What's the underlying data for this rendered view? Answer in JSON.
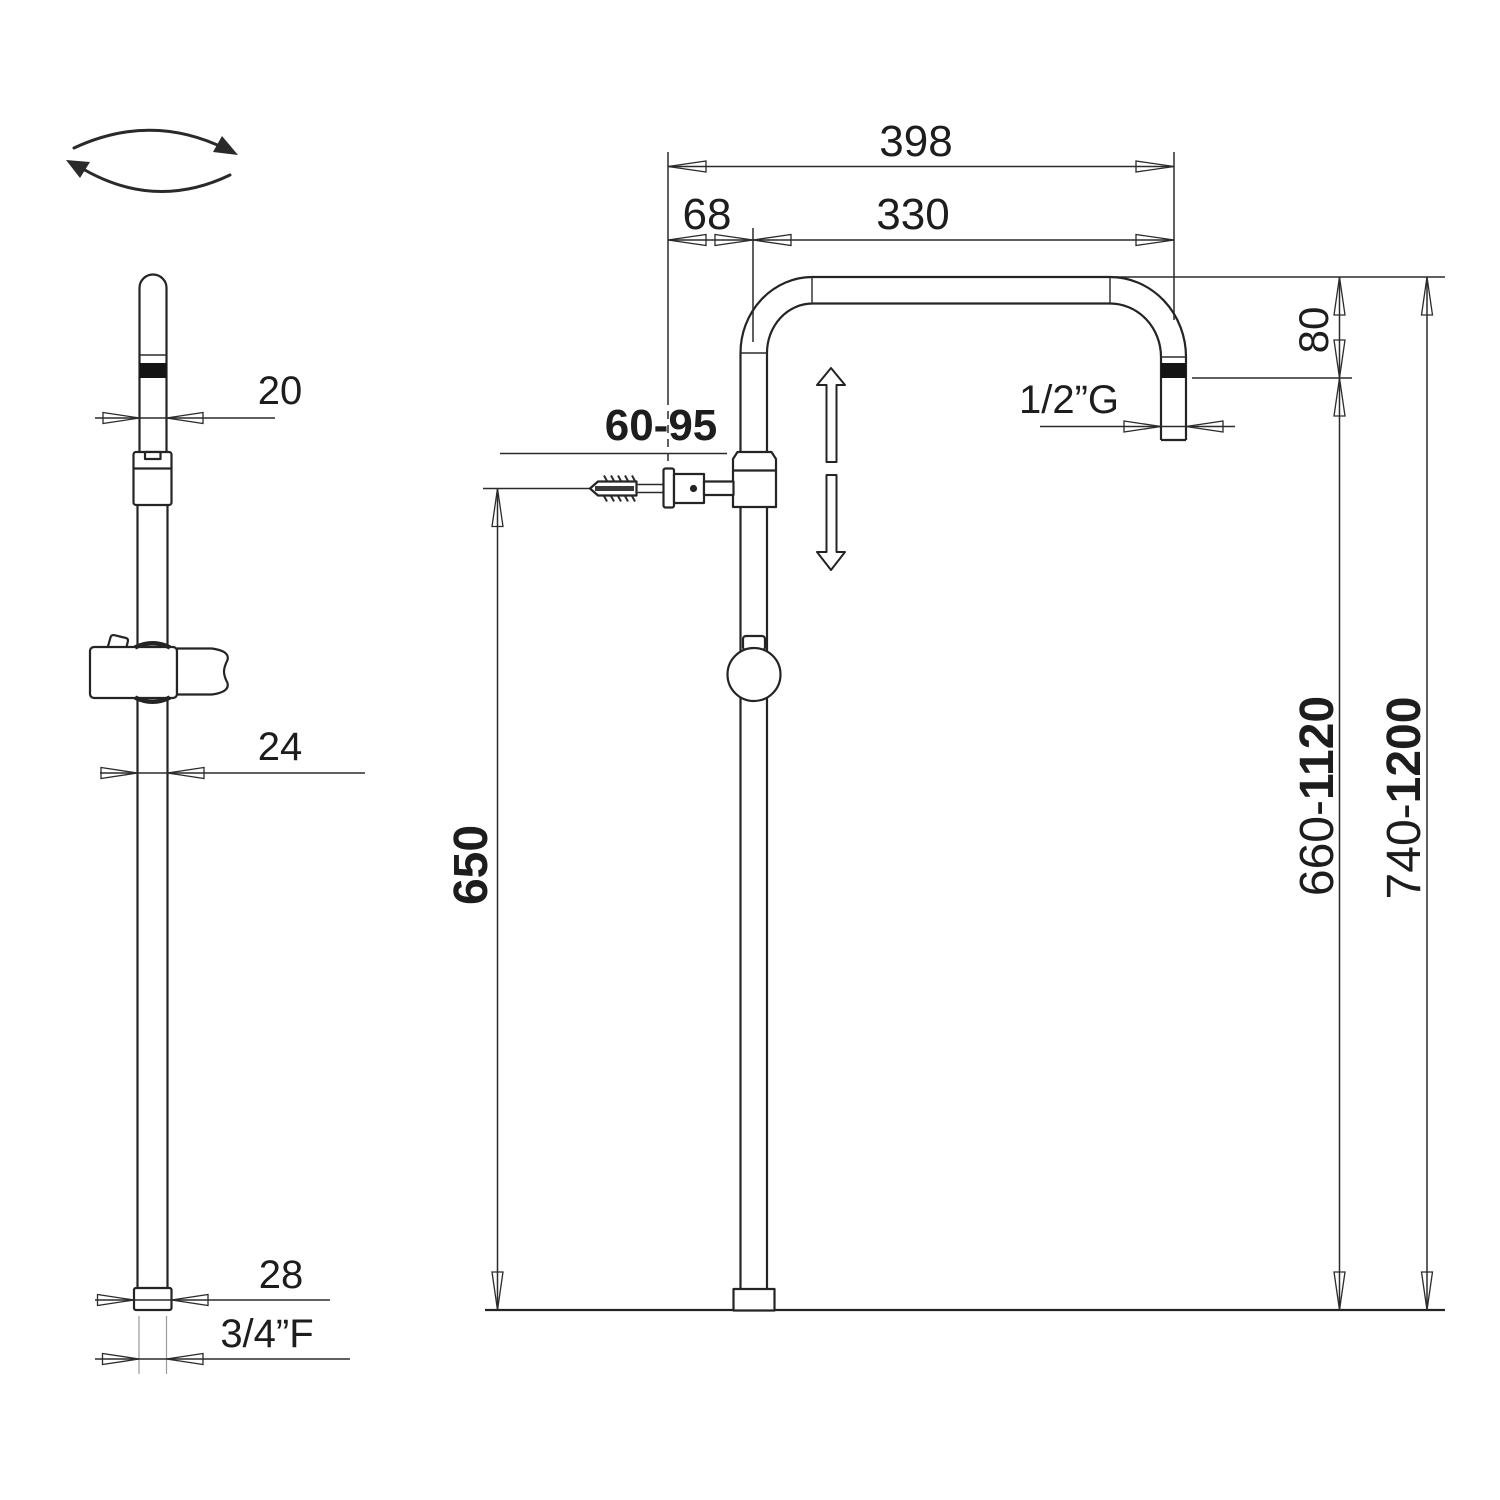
{
  "title": "Shower column technical dimension drawing",
  "colors": {
    "line": "#242424",
    "background": "#ffffff",
    "black_band": "#141414"
  },
  "icons": {
    "rotation": "swivel-rotation-arrows",
    "adjust": "up-down-adjust-arrows"
  },
  "side_view": {
    "dims": {
      "head_diameter": "20",
      "pole_diameter": "24",
      "base_diameter": "28",
      "base_thread": "3/4”F"
    }
  },
  "front_view": {
    "dims": {
      "overall_width": "398",
      "arm_reach": "330",
      "arm_offset": "68",
      "drop_height": "80",
      "head_thread": "1/2”G",
      "bracket_range": "60-95",
      "lower_height": "650",
      "riser_min_prefix": "660-",
      "riser_max": "1120",
      "total_min_prefix": "740-",
      "total_max": "1200"
    }
  }
}
